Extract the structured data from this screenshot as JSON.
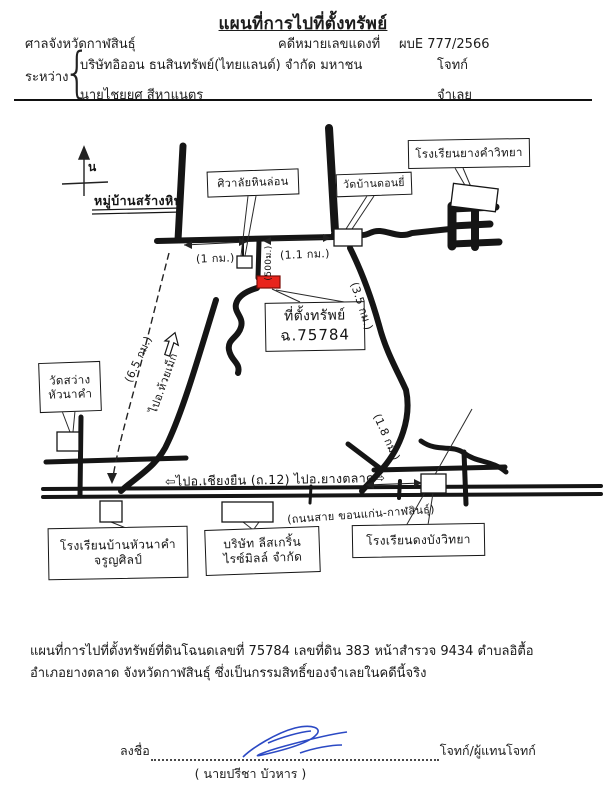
{
  "document": {
    "title": "แผนที่การไปที่ตั้งทรัพย์",
    "court": "ศาลจังหวัดกาฬสินธุ์",
    "case_label": "คดีหมายเลขแดงที่",
    "case_number": "ผบE 777/2566",
    "between": "ระหว่าง",
    "brace": "{",
    "plaintiff": "บริษัทอิออน ธนสินทรัพย์(ไทยแลนด์) จำกัด มหาชน",
    "plaintiff_role": "โจทก์",
    "defendant": "นายไชยยศ สีหาแนตร",
    "defendant_role": "จำเลย"
  },
  "map": {
    "compass": "น",
    "village": "หมู่บ้านสร้างหิน",
    "crematorium": "ศิวาลัยหินล่อน",
    "wat_don_yi": "วัดบ้านดอนยี่",
    "school_yang_kham": "โรงเรียนยางคำวิทยา",
    "wat_sawang_line1": "วัดสว่าง",
    "wat_sawang_line2": "หัวนาคำ",
    "property_line1": "ที่ตั้งทรัพย์",
    "property_line2": "ฉ.75784",
    "school_huanakham_line1": "โรงเรียนบ้านหัวนาคำ",
    "school_huanakham_line2": "จรูญศิลป์",
    "company_line1": "บริษัท ลีสเกริ้น",
    "company_line2": "ไรซ์มิลล์ จำกัด",
    "school_dong_bang": "โรงเรียนดงบังวิทยา",
    "dist_1km": "(1 กม.)",
    "dist_1_1km": "(1.1 กม.)",
    "dist_500m": "(500ม.)",
    "dist_3_5km": "(3.5 กม.)",
    "dist_6_5km": "(6.5 กม.)",
    "dist_1_8km": "(1.8 กม.)",
    "to_huai_mek": "ไปอ.ห้วยเม็ก",
    "highway_label": "⇦ไปอ.เชียงยืน (ถ.12) ไปอ.ยางตลาด⇨",
    "highway_name": "(ถนนสาย ขอนแก่น-กาฬสินธุ์)",
    "marker_color": "#e8241c"
  },
  "footer": {
    "desc_line1": "แผนที่การไปที่ตั้งทรัพย์ที่ดินโฉนดเลขที่  75784 เลขที่ดิน  383 หน้าสำรวจ 9434 ตำบลอิตื้อ",
    "desc_line2": "อำเภอยางตลาด  จังหวัดกาฬสินธุ์ ซึ่งเป็นกรรมสิทธิ์ของจำเลยในคดีนี้จริง",
    "sign_label": "ลงชื่อ",
    "sign_role": "โจทก์/ผู้แทนโจทก์",
    "signer": "( นายปรีชา   บัวหาร )"
  }
}
